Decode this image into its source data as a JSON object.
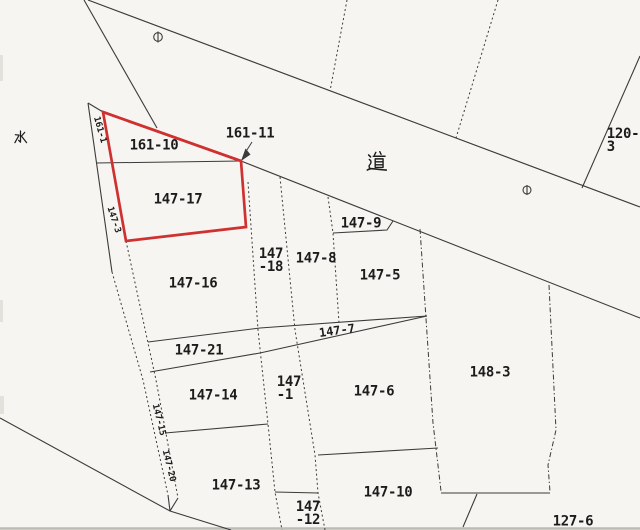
{
  "map": {
    "title": "cadastral parcel map",
    "colors": {
      "background": "#f6f5f1",
      "line": "#3b3b3b",
      "highlight": "#cf3131",
      "ink": "#1c1c1c"
    },
    "kanji_labels": {
      "water": "水",
      "road": "道"
    },
    "highlighted_parcel": "147-17",
    "parcel_labels": {
      "l161_10": {
        "text": "161-10"
      },
      "l161_11": {
        "text": "161-11"
      },
      "l120_3": {
        "text": "120-3"
      },
      "l147_17": {
        "text": "147-17"
      },
      "l147_9": {
        "text": "147-9"
      },
      "l147_18": {
        "text": "147\n-18"
      },
      "l147_8": {
        "text": "147-8"
      },
      "l147_5": {
        "text": "147-5"
      },
      "l147_16": {
        "text": "147-16"
      },
      "l147_21": {
        "text": "147-21"
      },
      "l147_7": {
        "text": "147-7"
      },
      "l148_3": {
        "text": "148-3"
      },
      "l147_14": {
        "text": "147-14"
      },
      "l147_1": {
        "text": "147\n-1"
      },
      "l147_6": {
        "text": "147-6"
      },
      "l147_13": {
        "text": "147-13"
      },
      "l147_12": {
        "text": "147\n-12"
      },
      "l147_10": {
        "text": "147-10"
      },
      "l127_6": {
        "text": "127-6"
      },
      "l161_1": {
        "text": "161-1"
      },
      "l147_3": {
        "text": "147-3"
      },
      "l147_15": {
        "text": "147-15"
      },
      "l147_20": {
        "text": "147-20"
      }
    }
  }
}
